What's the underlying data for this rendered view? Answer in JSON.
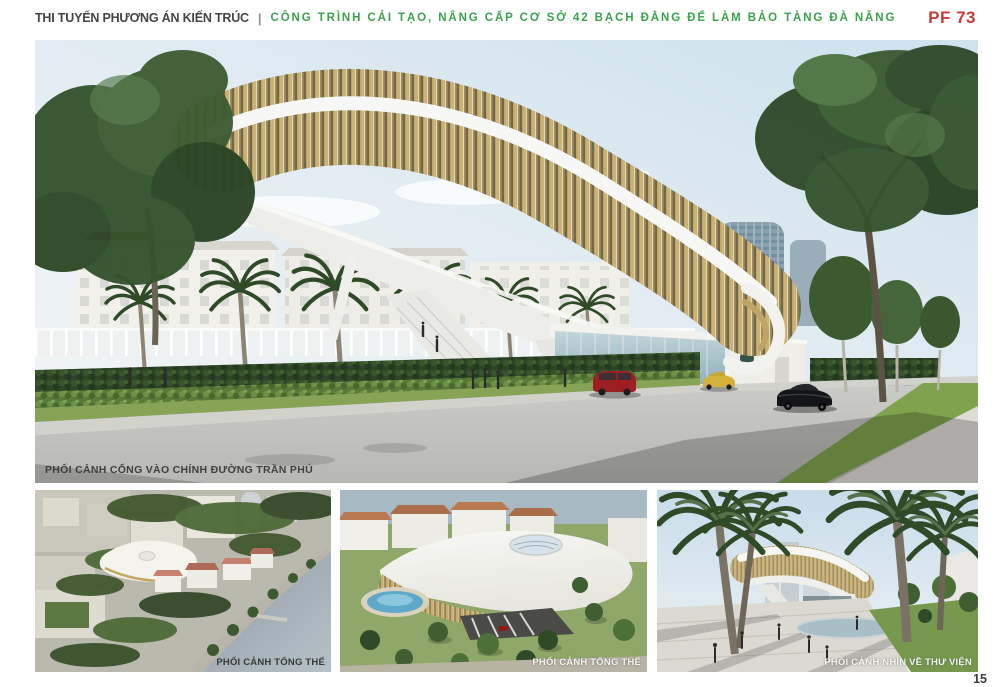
{
  "header": {
    "left_title": "THI TUYỂN PHƯƠNG ÁN KIẾN TRÚC",
    "separator": "|",
    "main_title": "CÔNG TRÌNH CẢI TẠO, NÂNG CẤP CƠ SỞ 42 BẠCH ĐẰNG ĐỂ LÀM BẢO TÀNG ĐÀ NẴNG",
    "code": "PF 73",
    "colors": {
      "left_title": "#454543",
      "main_title": "#3aa24d",
      "code": "#c63b3b"
    }
  },
  "main_view": {
    "caption": "PHỐI CẢNH CỔNG VÀO CHÍNH ĐƯỜNG TRẦN PHÚ"
  },
  "thumbnails": [
    {
      "caption": "PHỐI CẢNH TỔNG THỂ",
      "caption_style": "dark"
    },
    {
      "caption": "PHỐI CẢNH TỔNG THỂ",
      "caption_style": "light"
    },
    {
      "caption": "PHỐI CẢNH NHÌN VỀ THƯ VIỆN",
      "caption_style": "light"
    }
  ],
  "page": {
    "number": "15",
    "background": "#ffffff"
  },
  "palette": {
    "louver_gold": "#cdb272",
    "roof_white": "#f6f6f4",
    "foliage_green": "#33522c",
    "road_gray": "#c5c5c1",
    "sky_blue": "#d3e3ee"
  }
}
